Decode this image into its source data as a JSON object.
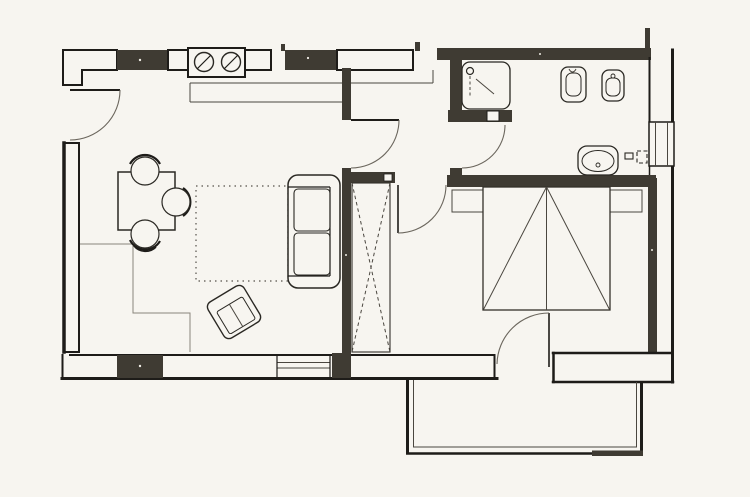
{
  "document": {
    "kind": "scanned architectural floor plan",
    "title": "",
    "visible_text": [],
    "style": "black ink line drawing on paper, filled masonry wall piers"
  },
  "colors": {
    "paper": "#f7f5f0",
    "ink": "#1e1c19",
    "wall_fill": "#3f3b33",
    "faint_line": "#6b665d"
  },
  "rooms": [
    {
      "name": "living-dining-kitchen",
      "position": "left"
    },
    {
      "name": "hallway",
      "position": "center-top"
    },
    {
      "name": "bathroom",
      "position": "top-right"
    },
    {
      "name": "bedroom",
      "position": "right"
    },
    {
      "name": "balcony",
      "position": "bottom-right-outside"
    }
  ],
  "fixtures": [
    {
      "name": "cooktop-two-burners",
      "room": "kitchen"
    },
    {
      "name": "kitchen-counter",
      "room": "kitchen"
    },
    {
      "name": "shower-tray",
      "room": "bathroom"
    },
    {
      "name": "toilet",
      "room": "bathroom"
    },
    {
      "name": "bidet",
      "room": "bathroom"
    },
    {
      "name": "washbasin",
      "room": "bathroom"
    },
    {
      "name": "radiator-symbol",
      "room": "bathroom"
    }
  ],
  "furniture": [
    {
      "name": "dining-table",
      "room": "living"
    },
    {
      "name": "chair",
      "count": 3,
      "room": "living"
    },
    {
      "name": "rug-dotted-outline",
      "room": "living"
    },
    {
      "name": "two-seat-sofa",
      "room": "living"
    },
    {
      "name": "armchair-rotated",
      "room": "living"
    },
    {
      "name": "built-in-wardrobe-x-symbol",
      "room": "bedroom"
    },
    {
      "name": "double-bed-with-diagonals",
      "room": "bedroom"
    },
    {
      "name": "nightstand",
      "count": 2,
      "room": "bedroom"
    }
  ],
  "doors": [
    {
      "name": "entrance-door",
      "wall": "left",
      "swing": "quarter-arc"
    },
    {
      "name": "living-to-hall-door",
      "wall": "center",
      "swing": "quarter-arc"
    },
    {
      "name": "bathroom-door",
      "wall": "hall-bath",
      "swing": "quarter-arc"
    },
    {
      "name": "bedroom-door",
      "wall": "hall-bedroom",
      "swing": "quarter-arc"
    },
    {
      "name": "balcony-door",
      "wall": "bedroom-south",
      "swing": "quarter-arc"
    }
  ],
  "windows": [
    {
      "name": "living-room-window-strip",
      "wall": "left"
    },
    {
      "name": "living-room-window",
      "wall": "bottom"
    },
    {
      "name": "bathroom-window",
      "wall": "right"
    }
  ]
}
